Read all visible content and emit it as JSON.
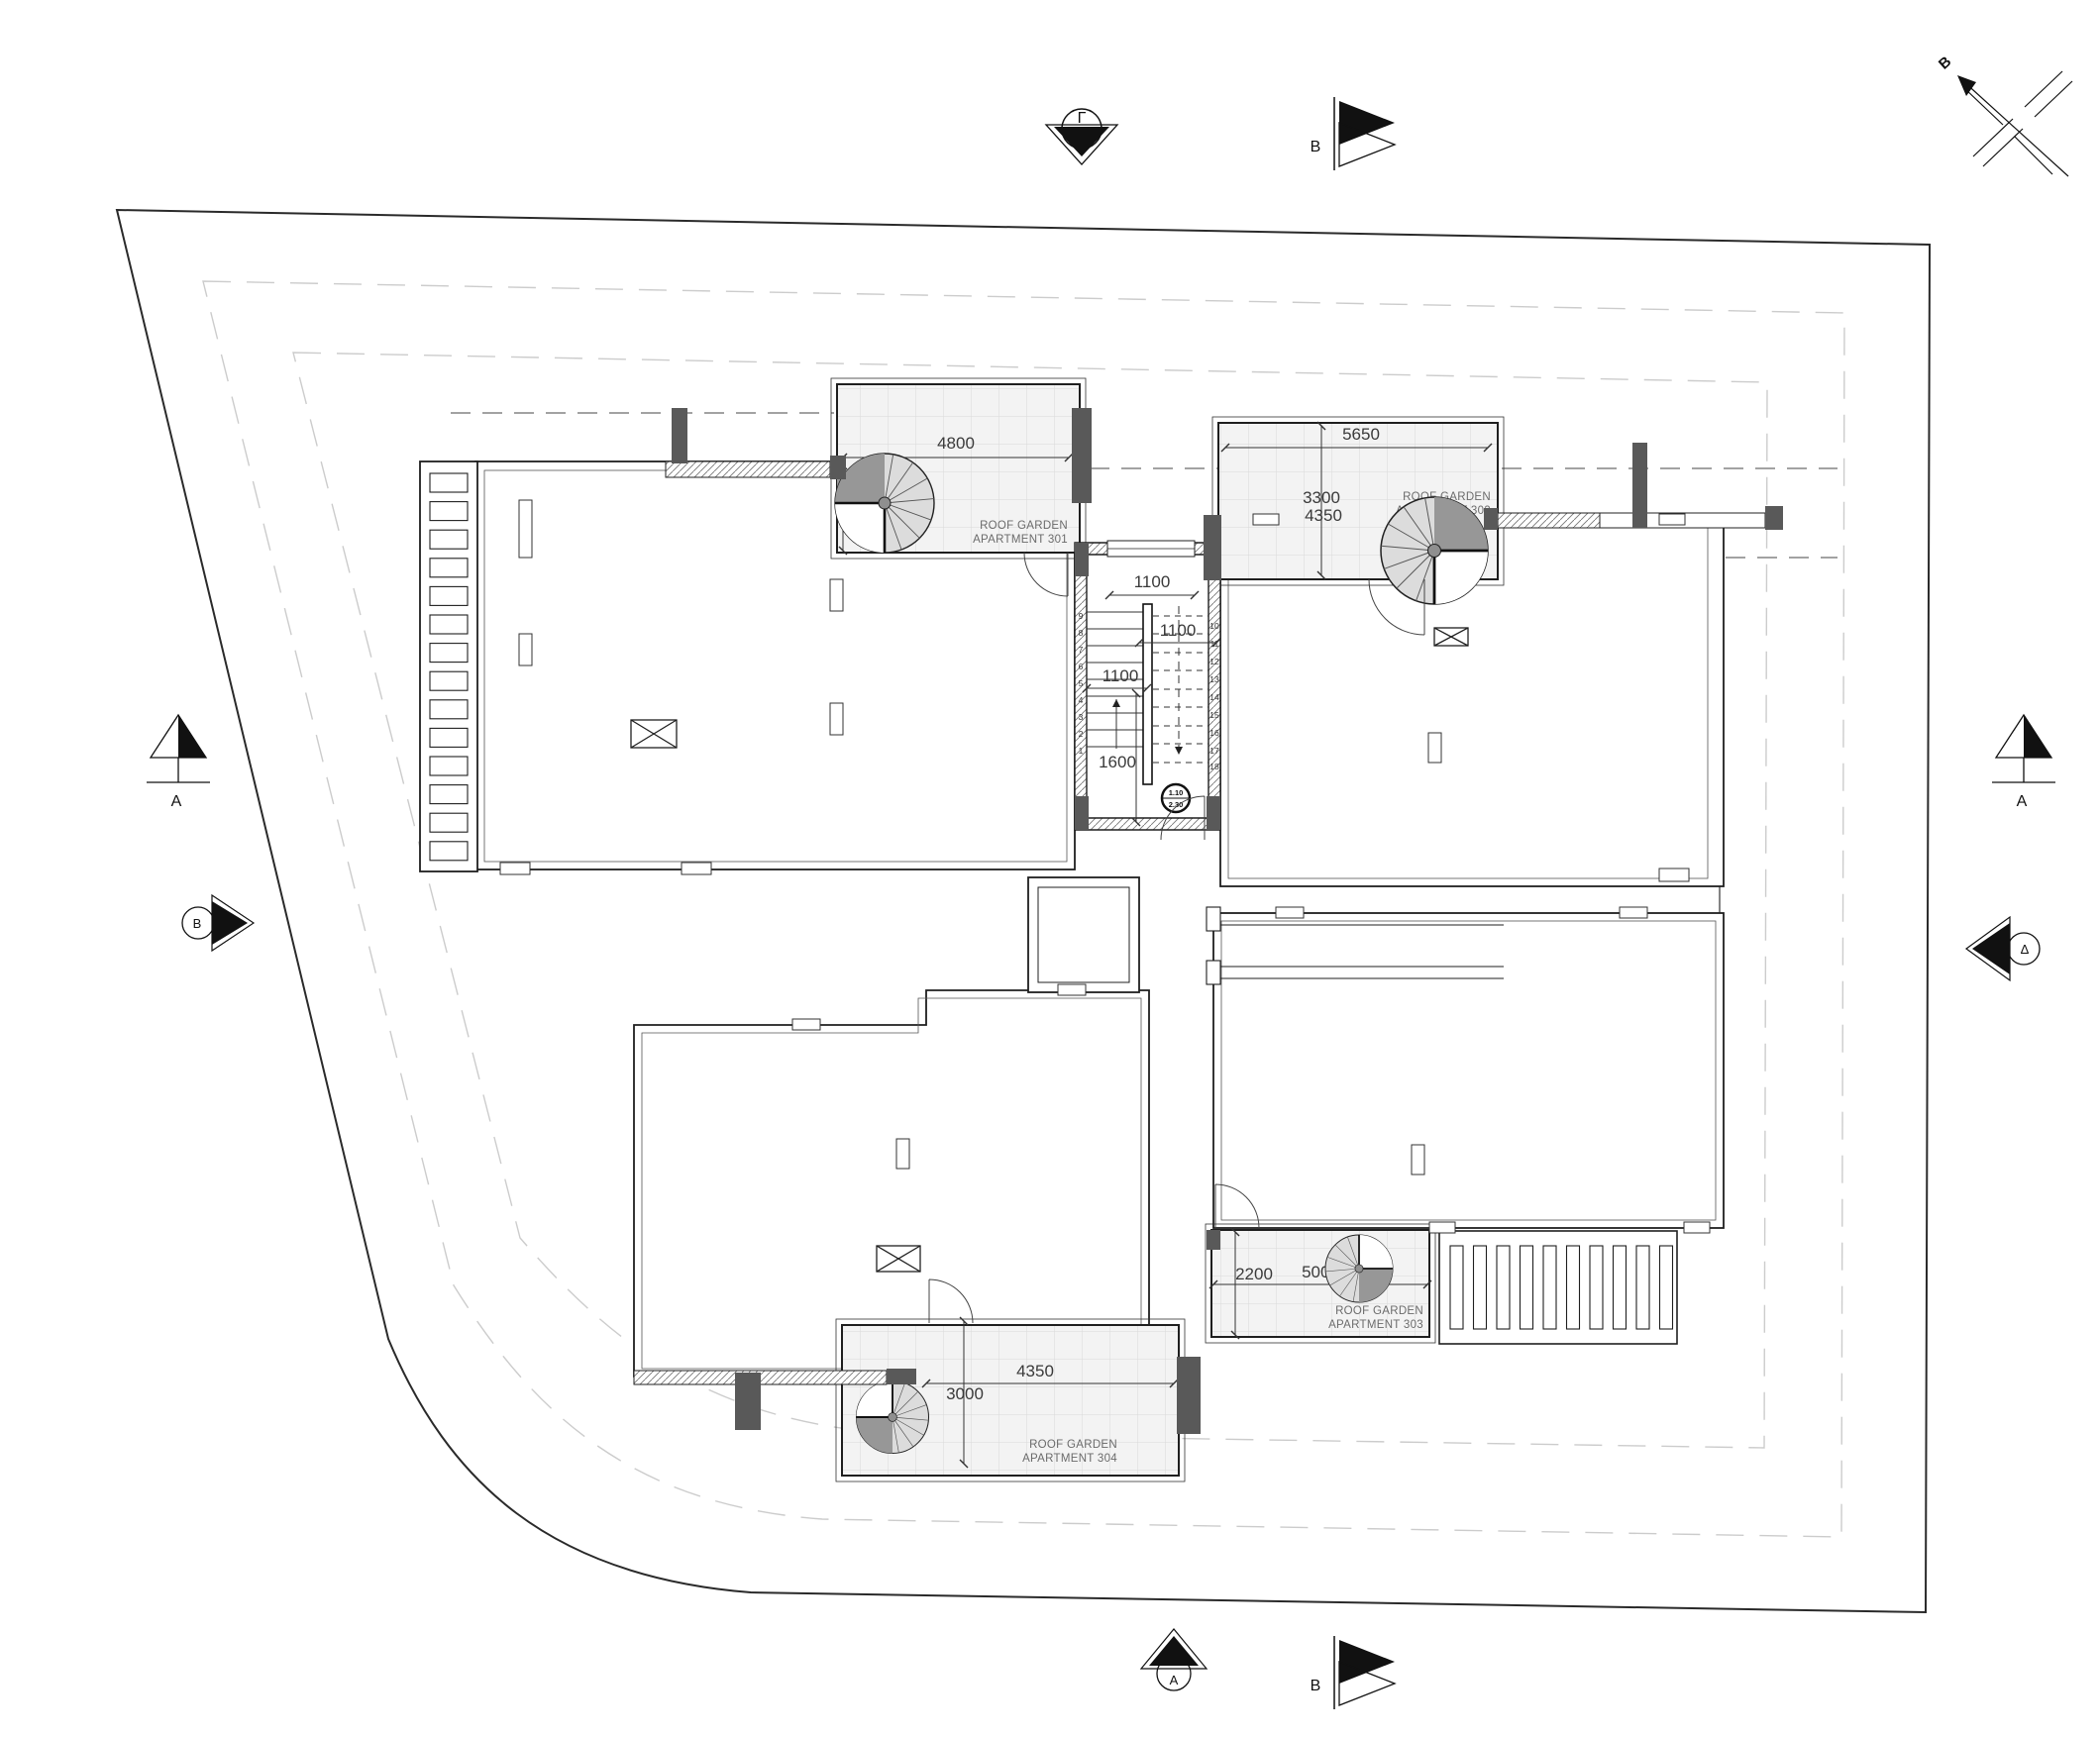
{
  "markers": {
    "north": "B",
    "top_section": "Γ",
    "top_cut": "B",
    "left_section": "A",
    "left_cut": "B",
    "right_section": "A",
    "right_cut": "Δ",
    "bottom_section": "A",
    "bottom_cut": "B"
  },
  "stair": {
    "dim_top": "1100",
    "dim_mid": "1100",
    "dim_left": "1100",
    "dim_bottom": "1600",
    "level_upper": "1.10",
    "level_lower": "2.30",
    "steps_left": [
      "1",
      "2",
      "3",
      "4",
      "5",
      "6",
      "7",
      "8",
      "9"
    ],
    "steps_right": [
      "10",
      "11",
      "12",
      "13",
      "14",
      "15",
      "16",
      "17",
      "18"
    ]
  },
  "gardens": [
    {
      "line1": "ROOF GARDEN",
      "line2": "APARTMENT 301",
      "dim_w": "4800",
      "dim_h": "3400"
    },
    {
      "line1": "ROOF GARDEN",
      "line2": "APARTMENT 302",
      "dim_w": "5650",
      "dim_h1": "3300",
      "dim_h2": "4350"
    },
    {
      "line1": "ROOF GARDEN",
      "line2": "APARTMENT 303",
      "dim_w": "5000",
      "dim_h": "2200"
    },
    {
      "line1": "ROOF GARDEN",
      "line2": "APARTMENT 304",
      "dim_w": "4350",
      "dim_h": "3000"
    }
  ],
  "colors": {
    "wall_dark": "#595959",
    "tile_fill": "#f3f3f3",
    "spiral_gray": "#dcdcdc",
    "spiral_dark": "#979797",
    "setback_dash": "#cccccc",
    "line": "#1f1f1f"
  }
}
